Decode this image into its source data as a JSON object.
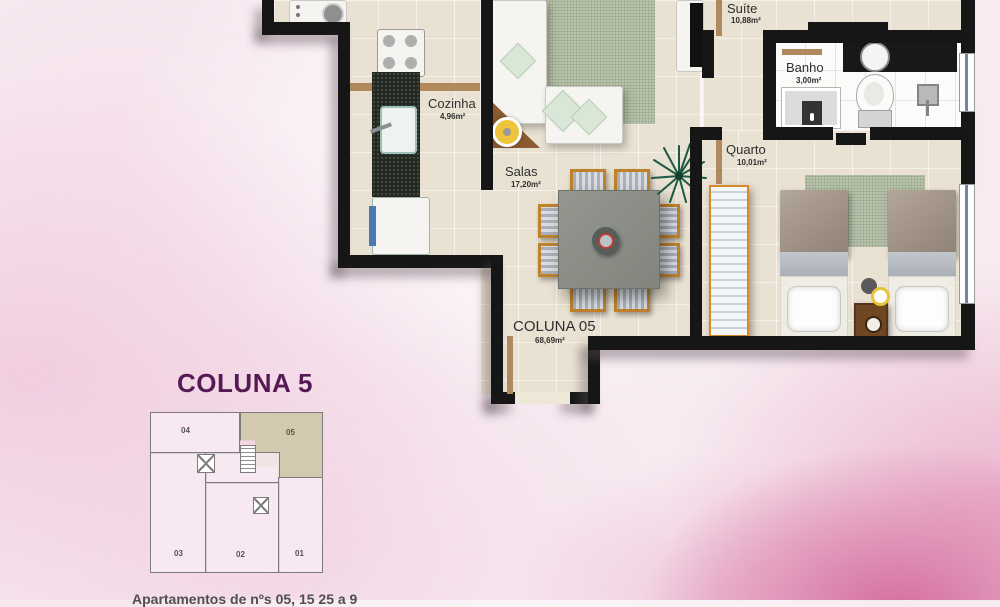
{
  "plan": {
    "rooms": {
      "suite": {
        "name": "Suíte",
        "area": "10,88m²"
      },
      "banho": {
        "name": "Banho",
        "area": "3,00m²"
      },
      "quarto": {
        "name": "Quarto",
        "area": "10,01m²"
      },
      "cozinha": {
        "name": "Cozinha",
        "area": "4,96m²"
      },
      "salas": {
        "name": "Salas",
        "area": "17,20m²"
      },
      "coluna": {
        "name": "COLUNA 05",
        "area": "68,69m²"
      }
    }
  },
  "key_plan": {
    "title": "COLUNA 5",
    "highlighted_unit": "05",
    "units": {
      "u01": "01",
      "u02": "02",
      "u03": "03",
      "u04": "04",
      "u05": "05"
    }
  },
  "caption": {
    "text": "Apartamentos de nºs 05, 15 25 a 9"
  },
  "colors": {
    "title_purple": "#551a56",
    "highlight_beige": "#d2c9ae",
    "wall_black": "#161616",
    "floor_beige": "#e9e1d1",
    "rug_green": "#b7c3aa",
    "background_pink": "#f3d9e6",
    "accent_rose": "#cf5f96"
  }
}
